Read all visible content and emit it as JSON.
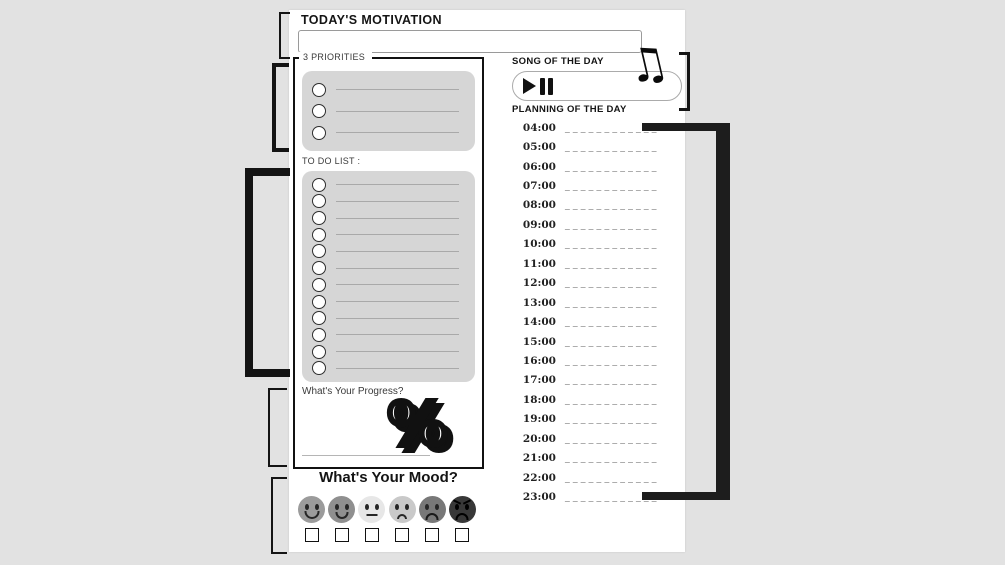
{
  "page": {
    "background_color": "#e2e2e2",
    "paper_color": "#ffffff",
    "box_fill_color": "#d6d6d6",
    "ink_color": "#141414"
  },
  "annotations": {
    "motivation": {
      "lines": [
        "citation de",
        "motivation",
        "quotidienne"
      ]
    },
    "smart": {
      "lines": [
        "Objectifs",
        "SMART"
      ]
    },
    "tasks": {
      "lines": [
        "Tâches à",
        "accomplir",
        "aujourd'hui"
      ]
    },
    "progress": {
      "lines": [
        "Pourcentage de",
        "progression"
      ]
    },
    "mood": {
      "lines": [
        "Sélectionnez",
        "votre emoji",
        "d'humeur"
      ]
    },
    "music": {
      "lines": [
        "Sélection",
        "musicale du jour"
      ]
    },
    "planning": {
      "lines": [
        "Programme et",
        "allocation du",
        "temps"
      ]
    }
  },
  "planner": {
    "motivation_title": "TODAY'S MOTIVATION",
    "motivation_value": "",
    "priorities_title": "3 PRIORITIES",
    "priorities_rows": 3,
    "todo_title": "TO DO LIST :",
    "todo_rows": 12,
    "song_title": "SONG OF THE DAY",
    "planning_title": "PLANNING OF THE DAY",
    "times": [
      "04:00",
      "05:00",
      "06:00",
      "07:00",
      "08:00",
      "09:00",
      "10:00",
      "11:00",
      "12:00",
      "13:00",
      "14:00",
      "15:00",
      "16:00",
      "17:00",
      "18:00",
      "19:00",
      "20:00",
      "21:00",
      "22:00",
      "23:00"
    ],
    "slot_line": "_ _ _ _ _ _ _ _ _ _ _ _",
    "progress_title": "What's Your Progress?",
    "percent_symbol": "%",
    "mood_title": "What's Your Mood?",
    "moods": [
      {
        "label": "very happy",
        "color": "#9b9b9b",
        "type": "big-smile"
      },
      {
        "label": "happy",
        "color": "#8f8f8f",
        "type": "smile"
      },
      {
        "label": "neutral",
        "color": "#e7e7e7",
        "type": "neutral"
      },
      {
        "label": "slightly sad",
        "color": "#c9c9c9",
        "type": "slight-frown"
      },
      {
        "label": "sad",
        "color": "#787878",
        "type": "frown"
      },
      {
        "label": "angry",
        "color": "#383838",
        "type": "angry"
      }
    ]
  },
  "icons": {
    "music_note": "♫"
  }
}
